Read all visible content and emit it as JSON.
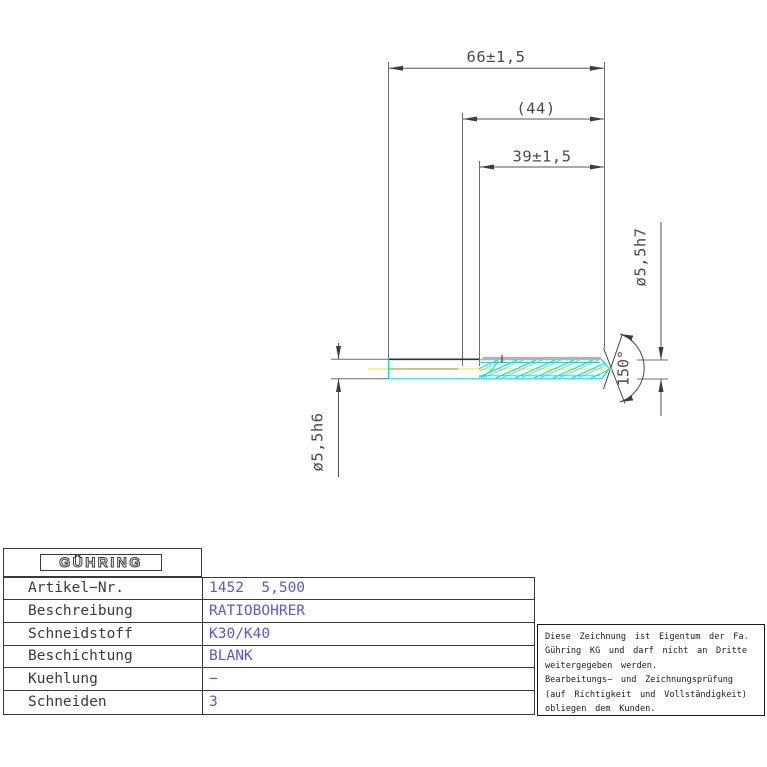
{
  "drawing": {
    "dims": {
      "overall_length": "66±1,5",
      "ref_length": "(44)",
      "flute_length": "39±1,5",
      "shank_diameter": "ø5,5h6",
      "cut_diameter": "ø5,5h7",
      "point_angle": "150°"
    },
    "colors": {
      "flute_cyan": "#00dede",
      "margin_red": "#ff5050",
      "centerline_yellow": "#ffe400",
      "centerline_olive": "#8f8f00",
      "line_gray": "#555555"
    }
  },
  "title_block": {
    "logo_text": "GÜHRING",
    "rows": [
      {
        "label": "Artikel−Nr.",
        "value": "1452  5,500"
      },
      {
        "label": "Beschreibung",
        "value": "RATIOBOHRER"
      },
      {
        "label": "Schneidstoff",
        "value": "K30/K40"
      },
      {
        "label": "Beschichtung",
        "value": "BLANK"
      },
      {
        "label": "Kuehlung",
        "value": "−"
      },
      {
        "label": "Schneiden",
        "value": "3"
      }
    ]
  },
  "note_box": {
    "lines": [
      "Diese Zeichnung ist Eigentum der Fa.",
      "Gühring KG und darf nicht an Dritte",
      "weitergegeben werden.",
      "Bearbeitungs− und Zeichnungsprüfung",
      "(auf Richtigkeit und Vollständigkeit)",
      "obliegen dem Kunden."
    ]
  }
}
